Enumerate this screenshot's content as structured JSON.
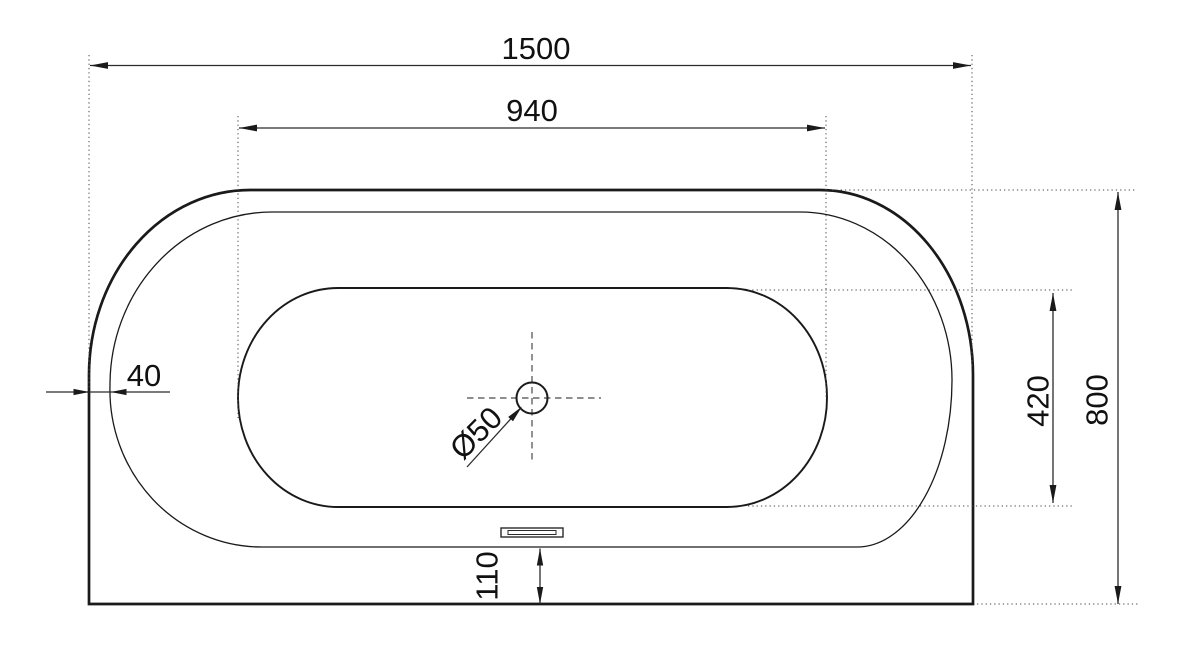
{
  "dimensions": {
    "overall_length": "1500",
    "front_edge_length": "940",
    "overall_depth": "800",
    "basin_width": "420",
    "front_rim_width": "40",
    "back_rim_width": "110",
    "drain_diameter": "Ø50"
  },
  "colors": {
    "outline": "#1a1a1a",
    "dimension_line": "#2b2b2b",
    "extension_line": "#4a4a4a",
    "text": "#111111",
    "background": "#ffffff"
  }
}
